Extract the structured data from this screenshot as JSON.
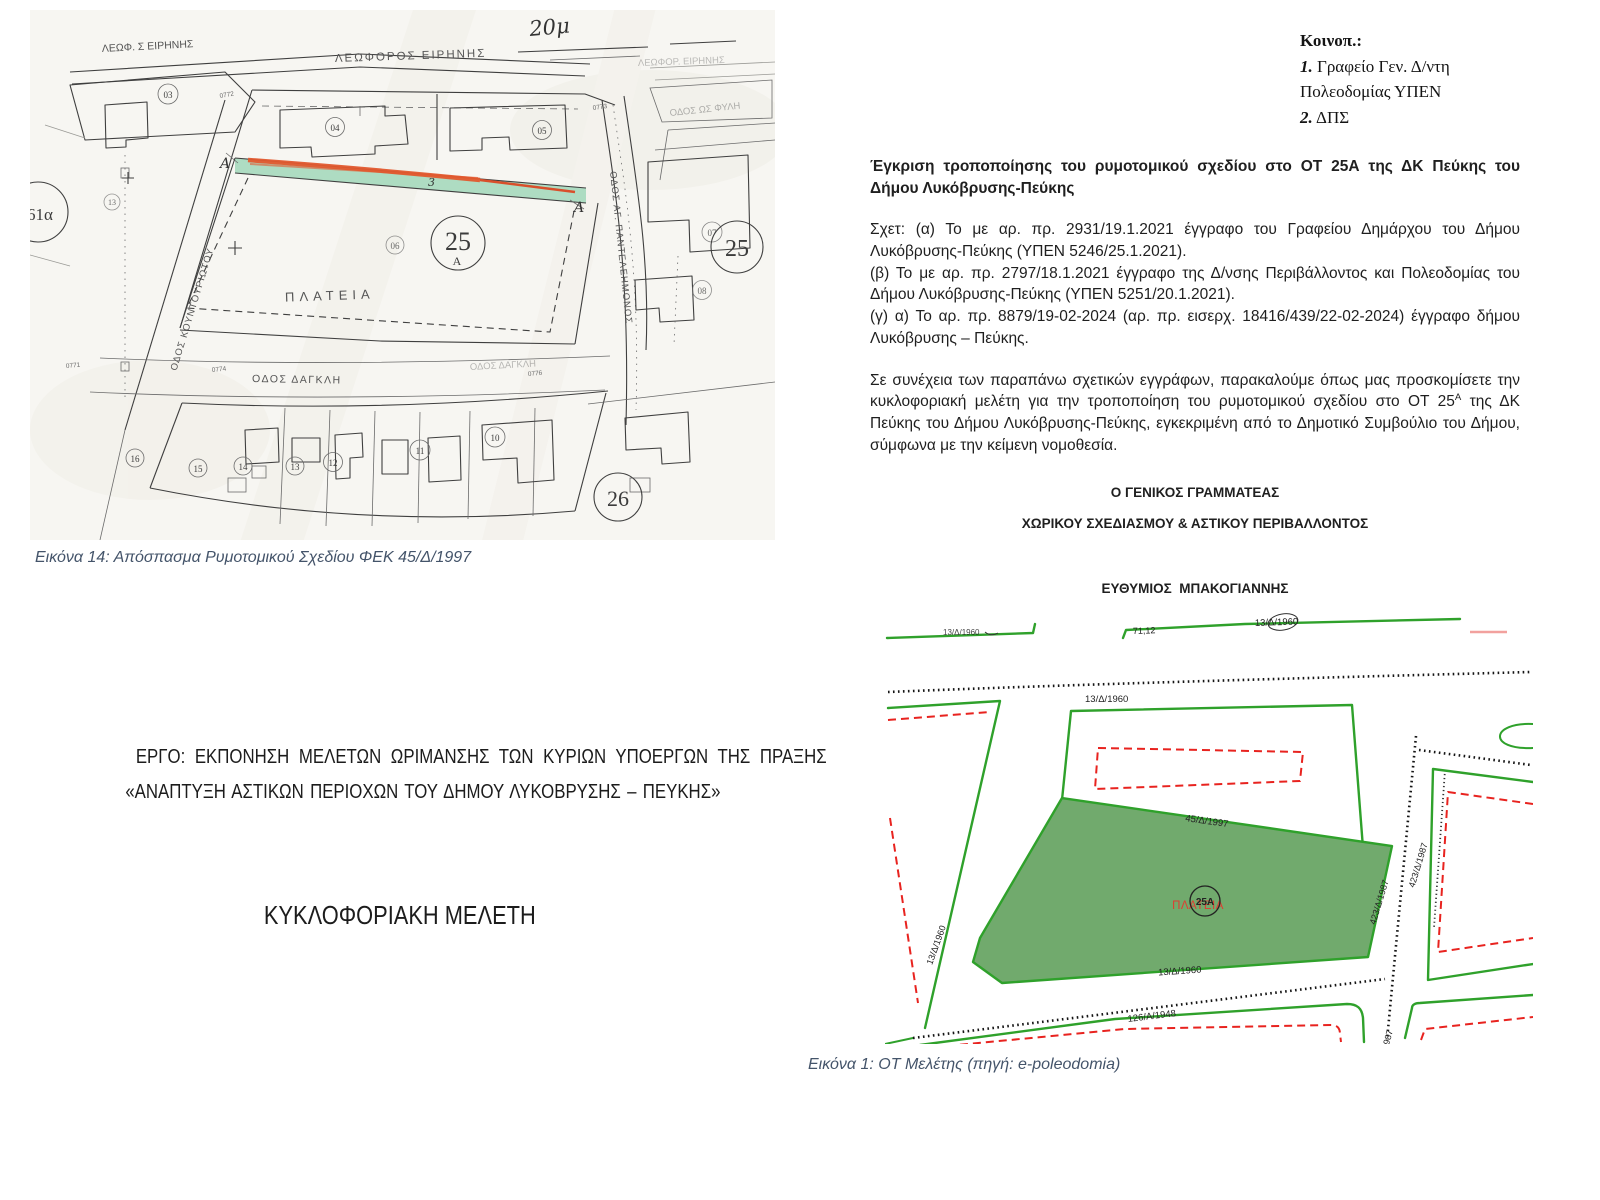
{
  "colors": {
    "caption": "#44546A",
    "map_green_line": "#2fa12b",
    "map_green_fill": "#71aa6d",
    "map_red_dashed": "#e8231f",
    "map_pink_line": "#f2a19e",
    "scan_paper": "#f7f6f2",
    "scan_highlight_green": "#a5d9bd",
    "scan_highlight_orange": "#e2582e"
  },
  "letter": {
    "distribution": {
      "header": "Κοινοπ.:",
      "item1_num": "1.",
      "item1": " Γραφείο Γεν. Δ/ντη",
      "item1b": "Πολεοδομίας ΥΠΕΝ",
      "item2_num": "2.",
      "item2": " ΔΠΣ"
    },
    "subject": "Έγκριση τροποποίησης του ρυμοτομικού σχεδίου στο ΟΤ 25Α της ΔΚ Πεύκης του Δήμου Λυκόβρυσης-Πεύκης",
    "ref_a": "Σχετ: (α) Το με αρ. πρ. 2931/19.1.2021 έγγραφο του Γραφείου Δημάρχου του Δήμου Λυκόβρυσης-Πεύκης (ΥΠΕΝ 5246/25.1.2021).",
    "ref_b": "(β) Το με αρ. πρ. 2797/18.1.2021 έγγραφο της Δ/νσης Περιβάλλοντος και Πολεοδομίας του Δήμου Λυκόβρυσης-Πεύκης (ΥΠΕΝ 5251/20.1.2021).",
    "ref_c": "(γ) α) Το αρ. πρ. 8879/19-02-2024 (αρ. πρ. εισερχ. 18416/439/22-02-2024) έγγραφο δήμου Λυκόβρυσης – Πεύκης.",
    "body_part1": "Σε συνέχεια των παραπάνω σχετικών εγγράφων, παρακαλούμε όπως μας προσκομίσετε την κυκλοφοριακή μελέτη για την τροποποίηση του ρυμοτομικού σχεδίου στο ΟΤ 25",
    "body_sup": "Α",
    "body_part2": " της ΔΚ Πεύκης του Δήμου Λυκόβρυσης-Πεύκης, εγκεκριμένη από το Δημοτικό Συμβούλιο του Δήμου, σύμφωνα με την κείμενη νομοθεσία.",
    "signature_title1": "Ο ΓΕΝΙΚΟΣ ΓΡΑΜΜΑΤΕΑΣ",
    "signature_title2": "ΧΩΡΙΚΟΥ ΣΧΕΔΙΑΣΜΟΥ & ΑΣΤΙΚΟΥ ΠΕΡΙΒΑΛΛΟΝΤΟΣ",
    "signature_name": "ΕΥΘΥΜΙΟΣ  ΜΠΑΚΟΓΙΑΝΝΗΣ"
  },
  "figure14": {
    "caption": "Εικόνα 14: Απόσπασμα Ρυμοτομικού Σχεδίου ΦΕΚ 45/Δ/1997",
    "map": {
      "scale_note": "20μ",
      "streets": {
        "top_left": "ΛΕΩΦ. Σ ΕΙΡΗΝΗΣ",
        "top": "ΛΕΩΦΟΡΟΣ ΕΙΡΗΝΗΣ",
        "top_right": "ΛΕΩΦΟΡ. ΕΙΡΗΝΗΣ",
        "right_upper": "ΟΔΟΣ ΩΣ ΦΥΛΗ",
        "left": "ΟΔΟΣ ΚΟΥΝΤΟΥΡΙΩΤΟΥ",
        "right": "ΟΔΟΣ ΑΓ. ΠΑΝΤΕΛΕΗΜΟΝΟΣ",
        "bottom": "ΟΔΟΣ ΔΑΓΚΛΗ",
        "bottom_right": "ΟΔΟΣ ΔΑΓΚΛΗ"
      },
      "plaza": "ΠΛΑΤΕΙΑ",
      "block_25A_number": "25",
      "block_25A_suffix": "Α",
      "block_25": "25",
      "block_26": "26",
      "section_letter_left": "Α",
      "section_letter_right": "Α",
      "strip_number": "3",
      "parcels": {
        "p03": "03",
        "p04": "04",
        "p05": "05",
        "p06": "06",
        "p07": "07",
        "p08": "08",
        "p61a": "61α",
        "p13l": "13",
        "p16": "16",
        "p15": "15",
        "p14": "14",
        "p13": "13",
        "p12": "12",
        "p11": "11",
        "p10": "10"
      },
      "elevations": {
        "e1": "0771",
        "e2": "0772",
        "e3": "0773",
        "e4": "0774",
        "e5": "0776"
      }
    }
  },
  "project": {
    "line1": "ΕΡΓΟ: ΕΚΠΟΝΗΣΗ ΜΕΛΕΤΩΝ ΩΡΙΜΑΝΣΗΣ ΤΩΝ ΚΥΡΙΩΝ ΥΠΟΕΡΓΩΝ ΤΗΣ ΠΡΑΞΗΣ",
    "line2": "«ΑΝΑΠΤΥΞΗ ΑΣΤΙΚΩΝ ΠΕΡΙΟΧΩΝ ΤΟΥ ΔΗΜΟΥ ΛΥΚΟΒΡΥΣΗΣ – ΠΕΥΚΗΣ»",
    "title": "ΚΥΚΛΟΦΟΡΙΑΚΗ ΜΕΛΕΤΗ"
  },
  "figure1": {
    "caption": "Εικόνα 1: ΟΤ Μελέτης (πηγή: e-poleodomia)",
    "map": {
      "labels": {
        "fek_top_clipped": "13/Δ/1960",
        "measure": "71,12",
        "fek_top_right": "13/Δ/1960",
        "fek_block_top": "13/Δ/1960",
        "fek_plaza_top": "45/Δ/1997",
        "fek_left_street": "13/Δ/1960",
        "fek_plaza_bottom": "13/Δ/1960",
        "fek_plaza_right": "423/Δ/1987",
        "fek_right_street": "423/Δ/1987",
        "fek_bottom": "126/Α/1948",
        "fek_bottom_clipped": "987"
      },
      "block_label": "25Α",
      "plaza_label": "ΠΛΑΤΕΙΑ"
    }
  }
}
